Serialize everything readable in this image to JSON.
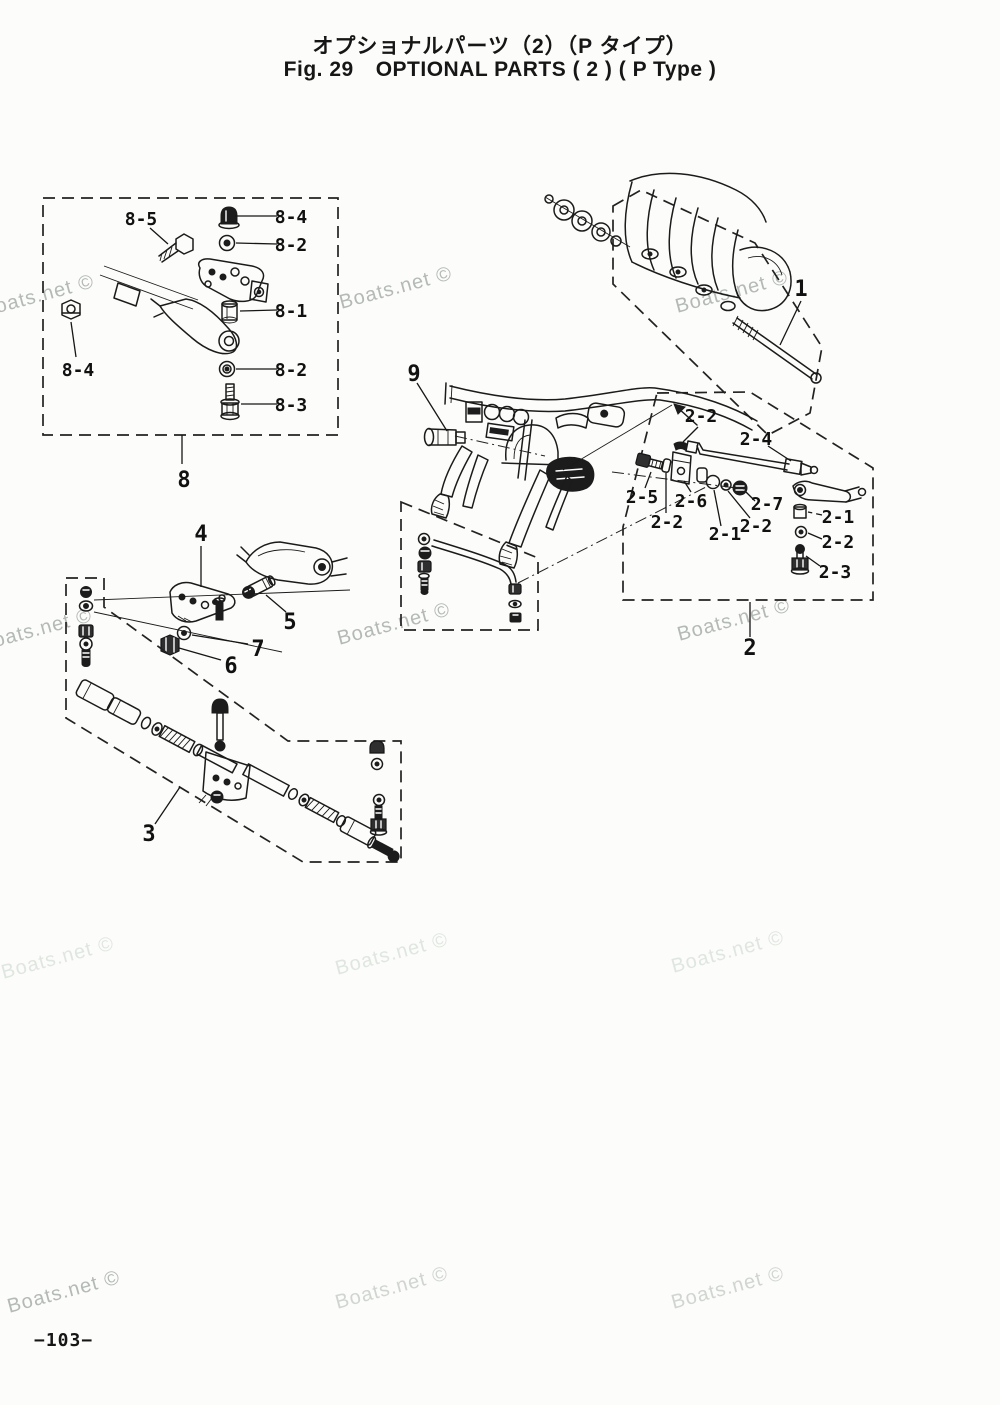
{
  "header": {
    "title_jp": "オプショナルパーツ（2）（P タイプ）",
    "fig_no": "Fig. 29",
    "title_en": "OPTIONAL PARTS ( 2 ) ( P Type )"
  },
  "watermark": {
    "text": "Boats.net ©"
  },
  "footer": {
    "page_number": "−103−"
  },
  "callouts": {
    "c8_5": "8-5",
    "c8_4_top": "8-4",
    "c8_2_top": "8-2",
    "c8_1": "8-1",
    "c8_4_left": "8-4",
    "c8_2_bottom": "8-2",
    "c8_3": "8-3",
    "c8": "8",
    "c1": "1",
    "c9": "9",
    "c2_2_a": "2-2",
    "c2_4": "2-4",
    "c2_5": "2-5",
    "c2_6": "2-6",
    "c2_2_b": "2-2",
    "c2_1_a": "2-1",
    "c2_2_c": "2-2",
    "c2_7": "2-7",
    "c2_1_b": "2-1",
    "c2_2_d": "2-2",
    "c2_3": "2-3",
    "c2": "2",
    "c4": "4",
    "c5": "5",
    "c6": "6",
    "c7": "7",
    "c3": "3"
  }
}
